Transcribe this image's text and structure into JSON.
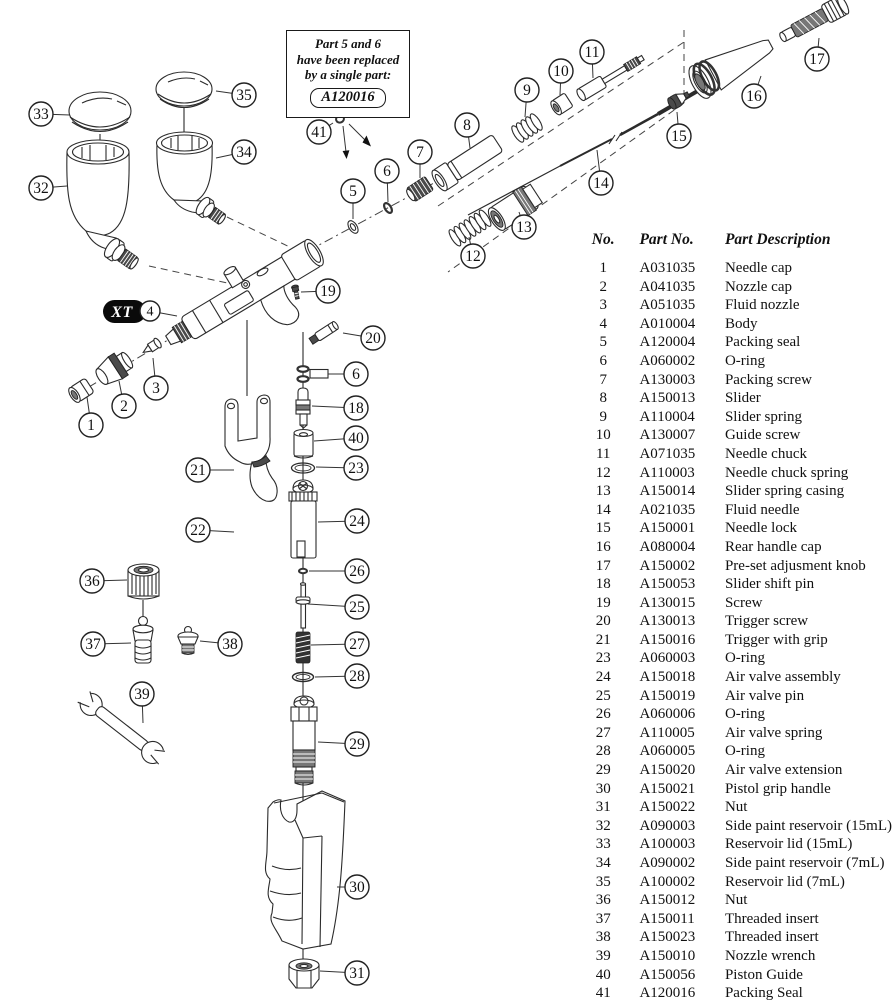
{
  "note_box": {
    "lines": [
      "Part 5 and 6",
      "have been replaced",
      "by a single part:"
    ],
    "part_number": "A120016"
  },
  "diagram": {
    "brand_label": "XT",
    "callouts": [
      {
        "label": "33",
        "x": 41,
        "y": 114,
        "lx": 70,
        "ly": 115
      },
      {
        "label": "35",
        "x": 244,
        "y": 95,
        "lx": 216,
        "ly": 91
      },
      {
        "label": "32",
        "x": 41,
        "y": 188,
        "lx": 67,
        "ly": 186
      },
      {
        "label": "34",
        "x": 244,
        "y": 152,
        "lx": 216,
        "ly": 158
      },
      {
        "label": "41",
        "x": 319,
        "y": 132,
        "lx": 333,
        "ly": 123
      },
      {
        "label": "5",
        "x": 353,
        "y": 191,
        "lx": 353,
        "ly": 219
      },
      {
        "label": "6",
        "x": 387,
        "y": 171,
        "lx": 388,
        "ly": 202
      },
      {
        "label": "7",
        "x": 420,
        "y": 152,
        "lx": 420,
        "ly": 178
      },
      {
        "label": "8",
        "x": 467,
        "y": 125,
        "lx": 470,
        "ly": 148
      },
      {
        "label": "9",
        "x": 527,
        "y": 90,
        "lx": 525,
        "ly": 117
      },
      {
        "label": "10",
        "x": 561,
        "y": 71,
        "lx": 560,
        "ly": 95
      },
      {
        "label": "11",
        "x": 592,
        "y": 52,
        "lx": 593,
        "ly": 78
      },
      {
        "label": "12",
        "x": 473,
        "y": 256,
        "lx": 469,
        "ly": 237
      },
      {
        "label": "13",
        "x": 524,
        "y": 227,
        "lx": 519,
        "ly": 212
      },
      {
        "label": "14",
        "x": 601,
        "y": 183,
        "lx": 597,
        "ly": 150
      },
      {
        "label": "15",
        "x": 679,
        "y": 136,
        "lx": 677,
        "ly": 112
      },
      {
        "label": "16",
        "x": 754,
        "y": 96,
        "lx": 761,
        "ly": 76
      },
      {
        "label": "17",
        "x": 817,
        "y": 59,
        "lx": 819,
        "ly": 38
      },
      {
        "label": "4",
        "x": 150,
        "y": 311,
        "lx": 177,
        "ly": 316,
        "r": 10
      },
      {
        "label": "19",
        "x": 328,
        "y": 291,
        "lx": 301,
        "ly": 292
      },
      {
        "label": "20",
        "x": 373,
        "y": 338,
        "lx": 343,
        "ly": 333
      },
      {
        "label": "6",
        "x": 356,
        "y": 374,
        "lx": 328,
        "ly": 374
      },
      {
        "label": "1",
        "x": 91,
        "y": 425,
        "lx": 87,
        "ly": 397
      },
      {
        "label": "2",
        "x": 124,
        "y": 406,
        "lx": 119,
        "ly": 381
      },
      {
        "label": "3",
        "x": 156,
        "y": 388,
        "lx": 153,
        "ly": 358
      },
      {
        "label": "18",
        "x": 356,
        "y": 408,
        "lx": 312,
        "ly": 406
      },
      {
        "label": "40",
        "x": 356,
        "y": 438,
        "lx": 314,
        "ly": 441
      },
      {
        "label": "23",
        "x": 356,
        "y": 468,
        "lx": 316,
        "ly": 467
      },
      {
        "label": "21",
        "x": 198,
        "y": 470,
        "lx": 234,
        "ly": 470
      },
      {
        "label": "24",
        "x": 357,
        "y": 521,
        "lx": 318,
        "ly": 522
      },
      {
        "label": "22",
        "x": 198,
        "y": 530,
        "lx": 234,
        "ly": 532
      },
      {
        "label": "26",
        "x": 357,
        "y": 571,
        "lx": 309,
        "ly": 571
      },
      {
        "label": "36",
        "x": 92,
        "y": 581,
        "lx": 127,
        "ly": 580
      },
      {
        "label": "25",
        "x": 357,
        "y": 607,
        "lx": 308,
        "ly": 604
      },
      {
        "label": "37",
        "x": 93,
        "y": 644,
        "lx": 131,
        "ly": 643
      },
      {
        "label": "38",
        "x": 230,
        "y": 644,
        "lx": 200,
        "ly": 641
      },
      {
        "label": "27",
        "x": 357,
        "y": 644,
        "lx": 311,
        "ly": 645
      },
      {
        "label": "28",
        "x": 357,
        "y": 676,
        "lx": 315,
        "ly": 677
      },
      {
        "label": "39",
        "x": 142,
        "y": 694,
        "lx": 143,
        "ly": 723
      },
      {
        "label": "29",
        "x": 357,
        "y": 744,
        "lx": 318,
        "ly": 742
      },
      {
        "label": "30",
        "x": 357,
        "y": 887,
        "lx": 337,
        "ly": 887
      },
      {
        "label": "31",
        "x": 357,
        "y": 973,
        "lx": 320,
        "ly": 971
      }
    ]
  },
  "parts_table": {
    "headers": [
      "No.",
      "Part No.",
      "Part Description"
    ],
    "rows": [
      {
        "no": "1",
        "part_no": "A031035",
        "description": "Needle cap"
      },
      {
        "no": "2",
        "part_no": "A041035",
        "description": "Nozzle cap"
      },
      {
        "no": "3",
        "part_no": "A051035",
        "description": "Fluid nozzle"
      },
      {
        "no": "4",
        "part_no": "A010004",
        "description": "Body"
      },
      {
        "no": "5",
        "part_no": "A120004",
        "description": "Packing seal"
      },
      {
        "no": "6",
        "part_no": "A060002",
        "description": "O-ring"
      },
      {
        "no": "7",
        "part_no": "A130003",
        "description": "Packing screw"
      },
      {
        "no": "8",
        "part_no": "A150013",
        "description": "Slider"
      },
      {
        "no": "9",
        "part_no": "A110004",
        "description": "Slider spring"
      },
      {
        "no": "10",
        "part_no": "A130007",
        "description": "Guide screw"
      },
      {
        "no": "11",
        "part_no": "A071035",
        "description": "Needle chuck"
      },
      {
        "no": "12",
        "part_no": "A110003",
        "description": "Needle chuck spring"
      },
      {
        "no": "13",
        "part_no": "A150014",
        "description": "Slider spring casing"
      },
      {
        "no": "14",
        "part_no": "A021035",
        "description": "Fluid needle"
      },
      {
        "no": "15",
        "part_no": "A150001",
        "description": "Needle lock"
      },
      {
        "no": "16",
        "part_no": "A080004",
        "description": "Rear handle cap"
      },
      {
        "no": "17",
        "part_no": "A150002",
        "description": "Pre-set adjusment knob"
      },
      {
        "no": "18",
        "part_no": "A150053",
        "description": "Slider shift pin"
      },
      {
        "no": "19",
        "part_no": "A130015",
        "description": "Screw"
      },
      {
        "no": "20",
        "part_no": "A130013",
        "description": "Trigger screw"
      },
      {
        "no": "21",
        "part_no": "A150016",
        "description": "Trigger with grip"
      },
      {
        "no": "23",
        "part_no": "A060003",
        "description": "O-ring"
      },
      {
        "no": "24",
        "part_no": "A150018",
        "description": "Air valve assembly"
      },
      {
        "no": "25",
        "part_no": "A150019",
        "description": "Air valve pin"
      },
      {
        "no": "26",
        "part_no": "A060006",
        "description": "O-ring"
      },
      {
        "no": "27",
        "part_no": "A110005",
        "description": "Air valve spring"
      },
      {
        "no": "28",
        "part_no": "A060005",
        "description": "O-ring"
      },
      {
        "no": "29",
        "part_no": "A150020",
        "description": "Air valve extension"
      },
      {
        "no": "30",
        "part_no": "A150021",
        "description": "Pistol grip handle"
      },
      {
        "no": "31",
        "part_no": "A150022",
        "description": "Nut"
      },
      {
        "no": "32",
        "part_no": "A090003",
        "description": "Side paint reservoir (15mL)"
      },
      {
        "no": "33",
        "part_no": "A100003",
        "description": "Reservoir lid (15mL)"
      },
      {
        "no": "34",
        "part_no": "A090002",
        "description": "Side paint reservoir (7mL)"
      },
      {
        "no": "35",
        "part_no": "A100002",
        "description": "Reservoir lid (7mL)"
      },
      {
        "no": "36",
        "part_no": "A150012",
        "description": "Nut"
      },
      {
        "no": "37",
        "part_no": "A150011",
        "description": "Threaded insert"
      },
      {
        "no": "38",
        "part_no": "A150023",
        "description": "Threaded insert"
      },
      {
        "no": "39",
        "part_no": "A150010",
        "description": "Nozzle wrench"
      },
      {
        "no": "40",
        "part_no": "A150056",
        "description": "Piston Guide"
      },
      {
        "no": "41",
        "part_no": "A120016",
        "description": "Packing Seal"
      }
    ]
  }
}
